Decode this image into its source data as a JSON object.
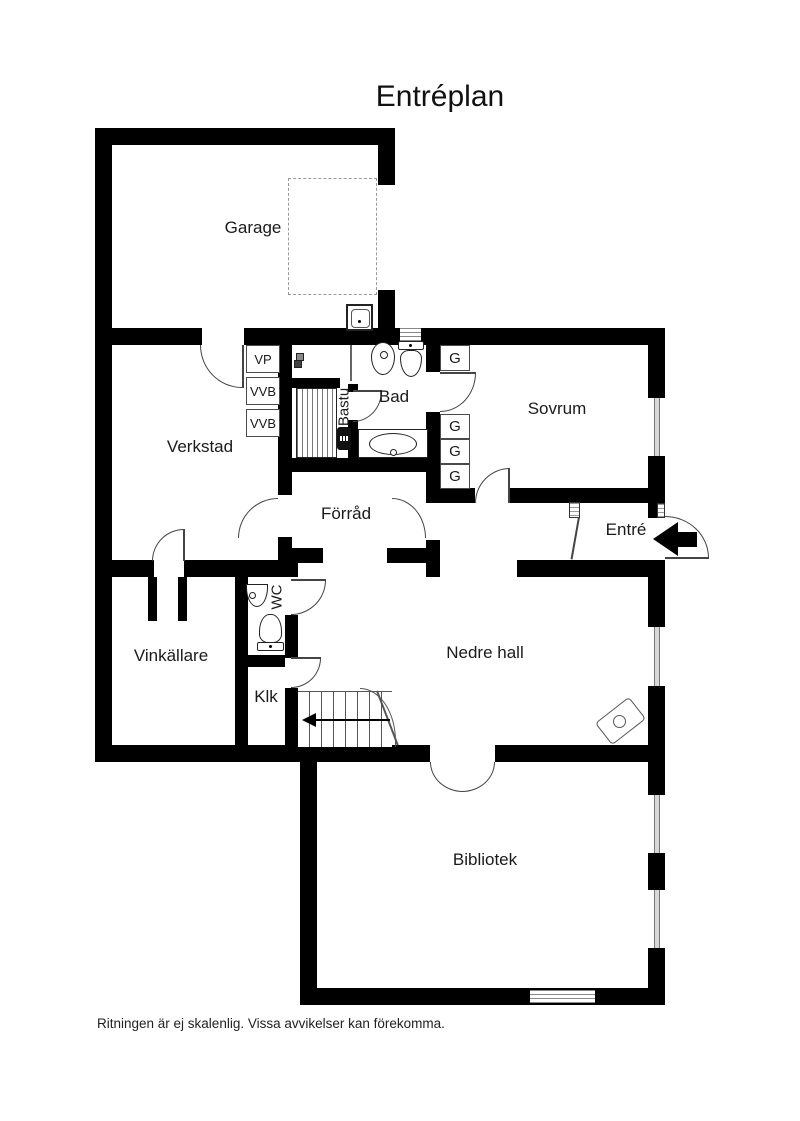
{
  "title": "Entréplan",
  "disclaimer": "Ritningen är ej skalenlig. Vissa avvikelser kan förekomma.",
  "rooms": {
    "garage": "Garage",
    "verkstad": "Verkstad",
    "bastu": "Bastu",
    "bad": "Bad",
    "sovrum": "Sovrum",
    "forrad": "Förråd",
    "entre": "Entré",
    "vinkallare": "Vinkällare",
    "wc": "WC",
    "klk": "Klk",
    "nedre_hall": "Nedre hall",
    "bibliotek": "Bibliotek"
  },
  "fixtures": {
    "vp": "VP",
    "vvb": "VVB",
    "wardrobe": "G"
  },
  "icons": {
    "entrance_arrow": "◀",
    "stairs_direction_arrow": "◀",
    "fixture_icons": [
      "garage-sink-icon",
      "floor-drain-icon",
      "sauna-heater-icon",
      "bidet-icon",
      "toilet-icon",
      "bathtub-icon",
      "wc-sink-icon",
      "wc-toilet-icon",
      "wood-stove-icon",
      "staircase-icon",
      "window-icon",
      "door-arc-icon"
    ]
  },
  "colors": {
    "wall": "#000000",
    "text": "#1a1a1a",
    "door_line": "#444444",
    "window_fill": "#d8d8d8",
    "dashed_outline": "#9a9a9a"
  }
}
